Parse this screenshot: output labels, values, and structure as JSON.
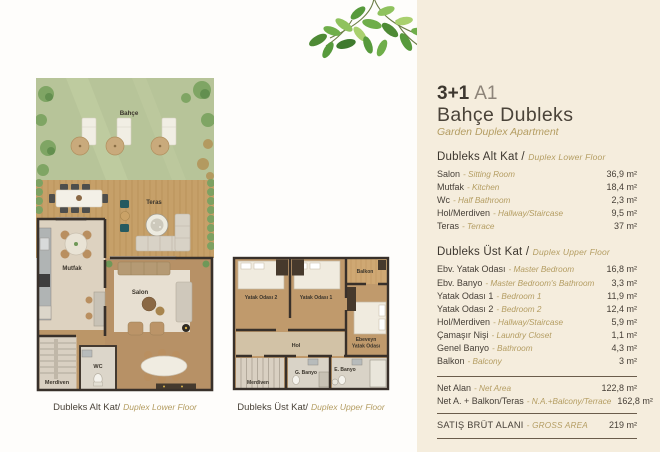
{
  "title": {
    "type": "3+1",
    "variant": "A1",
    "name_tr": "Bahçe Dubleks",
    "name_en": "Garden Duplex Apartment"
  },
  "lower_floor": {
    "heading_tr": "Dubleks Alt Kat /",
    "heading_en": "Duplex Lower Floor",
    "rows": [
      {
        "tr": "Salon",
        "en": "- Sitting Room",
        "value": "36,9 m²"
      },
      {
        "tr": "Mutfak",
        "en": "- Kitchen",
        "value": "18,4 m²"
      },
      {
        "tr": "Wc",
        "en": "- Half Bathroom",
        "value": "2,3 m²"
      },
      {
        "tr": "Hol/Merdiven",
        "en": "- Hallway/Staircase",
        "value": "9,5 m²"
      },
      {
        "tr": "Teras",
        "en": "- Terrace",
        "value": "37 m²"
      }
    ]
  },
  "upper_floor": {
    "heading_tr": "Dubleks Üst Kat /",
    "heading_en": "Duplex Upper Floor",
    "rows": [
      {
        "tr": "Ebv. Yatak Odası",
        "en": "- Master Bedroom",
        "value": "16,8 m²"
      },
      {
        "tr": "Ebv. Banyo",
        "en": "- Master Bedroom's Bathroom",
        "value": "3,3 m²"
      },
      {
        "tr": "Yatak Odası 1",
        "en": "- Bedroom 1",
        "value": "11,9 m²"
      },
      {
        "tr": "Yatak Odası 2",
        "en": "- Bedroom 2",
        "value": "12,4 m²"
      },
      {
        "tr": "Hol/Merdiven",
        "en": "- Hallway/Staircase",
        "value": "5,9 m²"
      },
      {
        "tr": "Çamaşır Nişi",
        "en": "- Laundry Closet",
        "value": "1,1 m²"
      },
      {
        "tr": "Genel Banyo",
        "en": "- Bathroom",
        "value": "4,3 m²"
      },
      {
        "tr": "Balkon",
        "en": "- Balcony",
        "value": "3 m²"
      }
    ]
  },
  "totals": {
    "net": {
      "tr": "Net Alan",
      "en": "- Net Area",
      "value": "122,8 m²"
    },
    "net_plus": {
      "tr": "Net A. + Balkon/Teras",
      "en": "- N.A.+Balcony/Terrace",
      "value": "162,8 m²"
    },
    "gross": {
      "tr": "SATIŞ BRÜT ALANI",
      "en": "- GROSS AREA",
      "value": "219 m²"
    }
  },
  "plan_lower": {
    "caption_tr": "Dubleks Alt Kat/",
    "caption_en": "Duplex Lower Floor",
    "labels": {
      "garden": "Bahçe",
      "terrace": "Teras",
      "kitchen": "Mutfak",
      "salon": "Salon",
      "wc": "WC",
      "stairs": "Merdiven"
    }
  },
  "plan_upper": {
    "caption_tr": "Dubleks Üst Kat/",
    "caption_en": "Duplex Upper Floor",
    "labels": {
      "bedroom2": "Yatak Odası 2",
      "bedroom1": "Yatak Odası 1",
      "balcony": "Balkon",
      "master_line1": "Ebeveyn",
      "master_line2": "Yatak Odası",
      "hall": "Hol",
      "stairs": "Merdiven",
      "bath_g": "G. Banyo",
      "bath_e": "E. Banyo"
    }
  },
  "colors": {
    "accent_gold": "#b49d62",
    "panel_beige": "#f5eddd",
    "garden_green": "#b7c499",
    "deck_wood": "#c6a069",
    "wall_dark": "#38302a"
  }
}
